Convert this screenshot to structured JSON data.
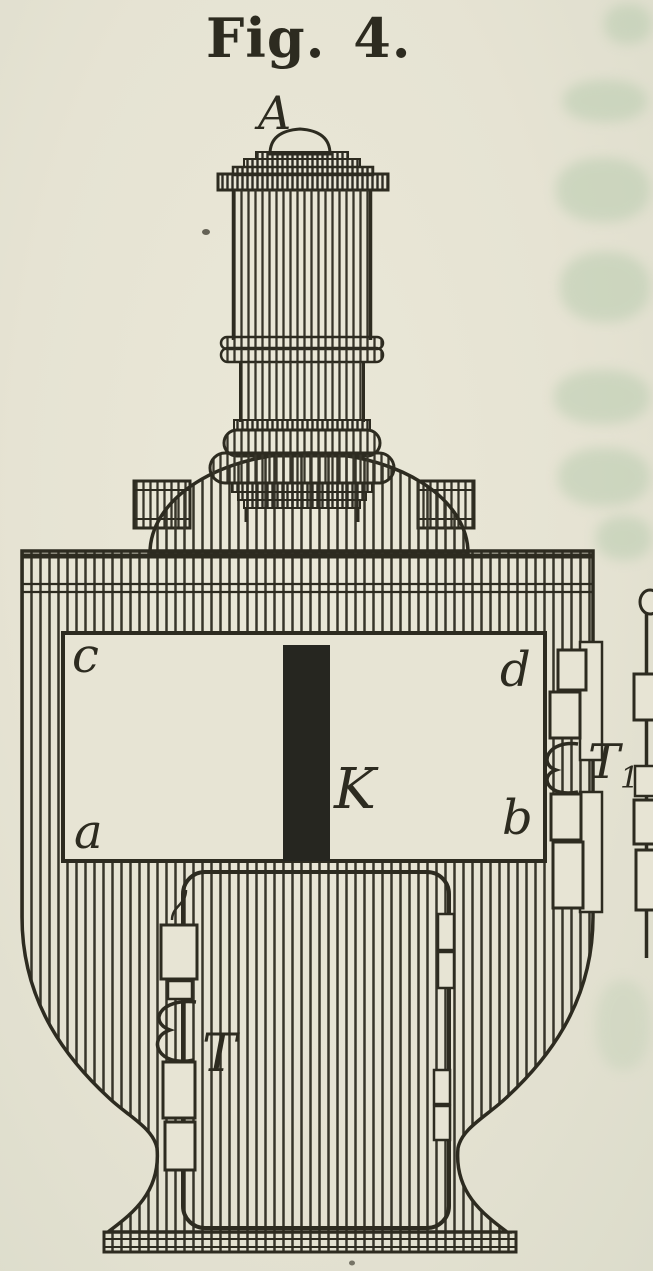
{
  "figure": {
    "title": "Fig. 4.",
    "labels": {
      "apparatus_top": "A",
      "window_top_left": "c",
      "window_top_right": "d",
      "window_bottom_left": "a",
      "window_bottom_right": "b",
      "rod": "K",
      "right_terminal_base": "T",
      "right_terminal_subscript": "1",
      "door_terminal": "T"
    },
    "colors": {
      "paper": "#e7e4d4",
      "ink": "#2d2b20",
      "showthrough_green": "#adc6a6"
    }
  }
}
